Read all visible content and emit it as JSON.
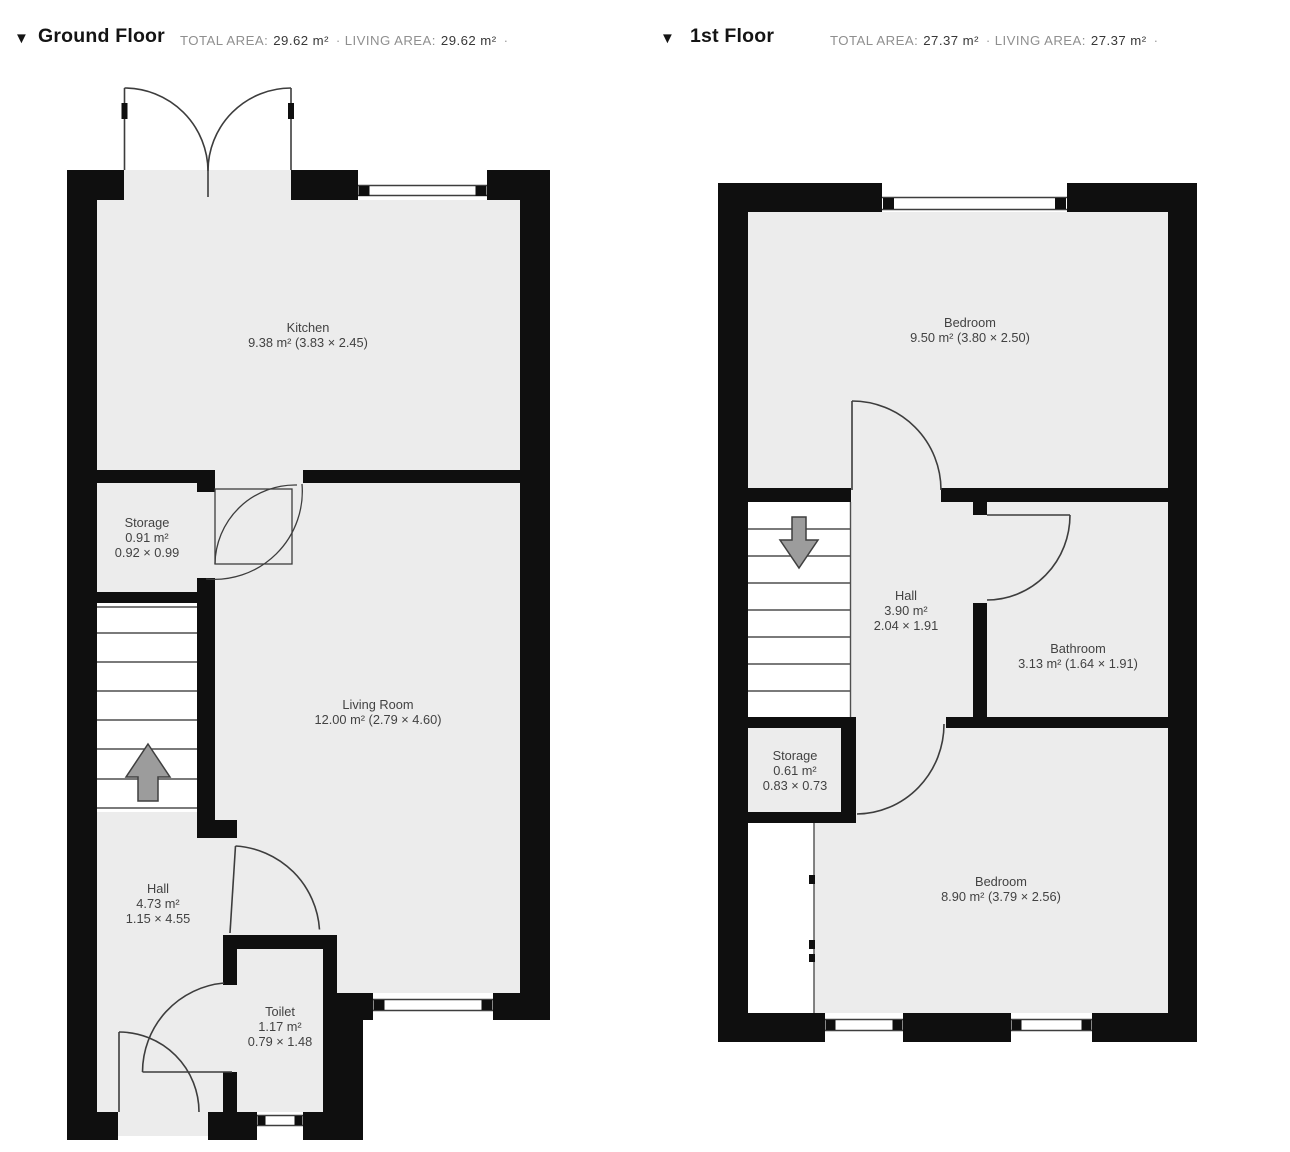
{
  "colors": {
    "wall": "#0f0f0f",
    "floor": "#ececec",
    "line": "#3d3d3d",
    "stairs_fill": "#ffffff",
    "arrow_fill": "#9c9c9c",
    "label_text": "#424242",
    "header_title": "#141414",
    "stats_label": "#8f8f8f",
    "stats_value": "#383838"
  },
  "floors": [
    {
      "id": "ground-floor",
      "collapse_icon": "▼",
      "title": "Ground Floor",
      "stats": {
        "total_label": "TOTAL AREA:",
        "total_value": "29.62 m²",
        "separator": "·",
        "living_label": "LIVING AREA:",
        "living_value": "29.62 m²",
        "trailing_separator": "·"
      },
      "rooms": [
        {
          "id": "kitchen",
          "lines": [
            "Kitchen",
            "9.38 m² (3.83 × 2.45)"
          ]
        },
        {
          "id": "storage",
          "lines": [
            "Storage",
            "0.91 m²",
            "0.92 × 0.99"
          ]
        },
        {
          "id": "living-room",
          "lines": [
            "Living Room",
            "12.00 m² (2.79 × 4.60)"
          ]
        },
        {
          "id": "hall",
          "lines": [
            "Hall",
            "4.73 m²",
            "1.15 × 4.55"
          ]
        },
        {
          "id": "toilet",
          "lines": [
            "Toilet",
            "1.17 m²",
            "0.79 × 1.48"
          ]
        }
      ]
    },
    {
      "id": "first-floor",
      "collapse_icon": "▼",
      "title": "1st Floor",
      "stats": {
        "total_label": "TOTAL AREA:",
        "total_value": "27.37 m²",
        "separator": "·",
        "living_label": "LIVING AREA:",
        "living_value": "27.37 m²",
        "trailing_separator": "·"
      },
      "rooms": [
        {
          "id": "bedroom-front",
          "lines": [
            "Bedroom",
            "9.50 m² (3.80 × 2.50)"
          ]
        },
        {
          "id": "hall",
          "lines": [
            "Hall",
            "3.90 m²",
            "2.04 × 1.91"
          ]
        },
        {
          "id": "bathroom",
          "lines": [
            "Bathroom",
            "3.13 m² (1.64 × 1.91)"
          ]
        },
        {
          "id": "storage",
          "lines": [
            "Storage",
            "0.61 m²",
            "0.83 × 0.73"
          ]
        },
        {
          "id": "bedroom-back",
          "lines": [
            "Bedroom",
            "8.90 m² (3.79 × 2.56)"
          ]
        }
      ]
    }
  ]
}
